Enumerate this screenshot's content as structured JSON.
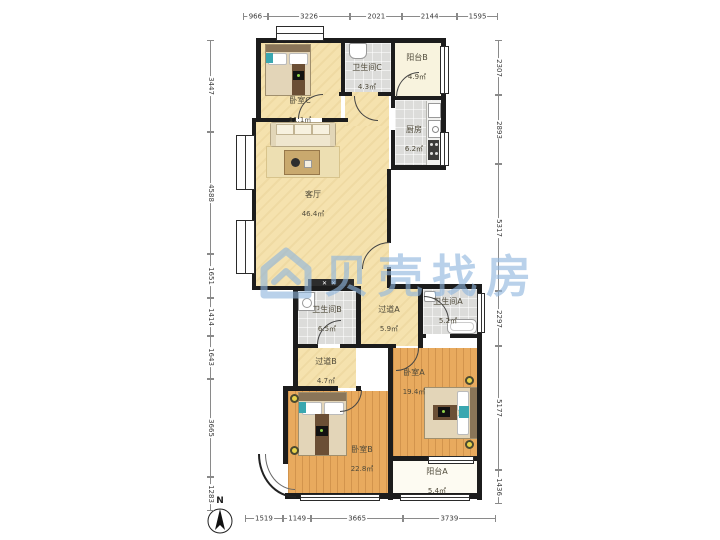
{
  "watermark": {
    "brand": "贝壳找房",
    "logo": "beike-house-logo"
  },
  "compass": {
    "label": "N"
  },
  "rooms": {
    "bedroomC": {
      "name": "卧室C",
      "area": "11.1㎡"
    },
    "bathroomC": {
      "name": "卫生间C",
      "area": "4.3㎡"
    },
    "balconyB": {
      "name": "阳台B",
      "area": "4.9㎡"
    },
    "kitchen": {
      "name": "厨房",
      "area": "6.2㎡"
    },
    "living": {
      "name": "客厅",
      "area": "46.4㎡"
    },
    "bathroomB": {
      "name": "卫生间B",
      "area": "6.5㎡"
    },
    "hallwayA": {
      "name": "过道A",
      "area": "5.9㎡"
    },
    "bathroomA": {
      "name": "卫生间A",
      "area": "5.2㎡"
    },
    "hallwayB": {
      "name": "过道B",
      "area": "4.7㎡"
    },
    "bedroomA": {
      "name": "卧室A",
      "area": "19.4㎡"
    },
    "bedroomB": {
      "name": "卧室B",
      "area": "22.8㎡"
    },
    "balconyA": {
      "name": "阳台A",
      "area": "5.4㎡"
    }
  },
  "dimensions": {
    "top": [
      966,
      3226,
      2021,
      2144,
      1595
    ],
    "bottom": [
      1519,
      1149,
      3665,
      3739
    ],
    "left": [
      3447,
      4588,
      1651,
      1414,
      1643,
      3665,
      1283
    ],
    "right": [
      2307,
      2893,
      5317,
      2297,
      5177,
      1436
    ]
  },
  "colors": {
    "wall": "#1c1c1c",
    "floor_tan": "#f5e2ae",
    "floor_wood": "#e8aa5e",
    "floor_tile": "#dcdcda",
    "watermark_blue": "#8fb6de"
  }
}
